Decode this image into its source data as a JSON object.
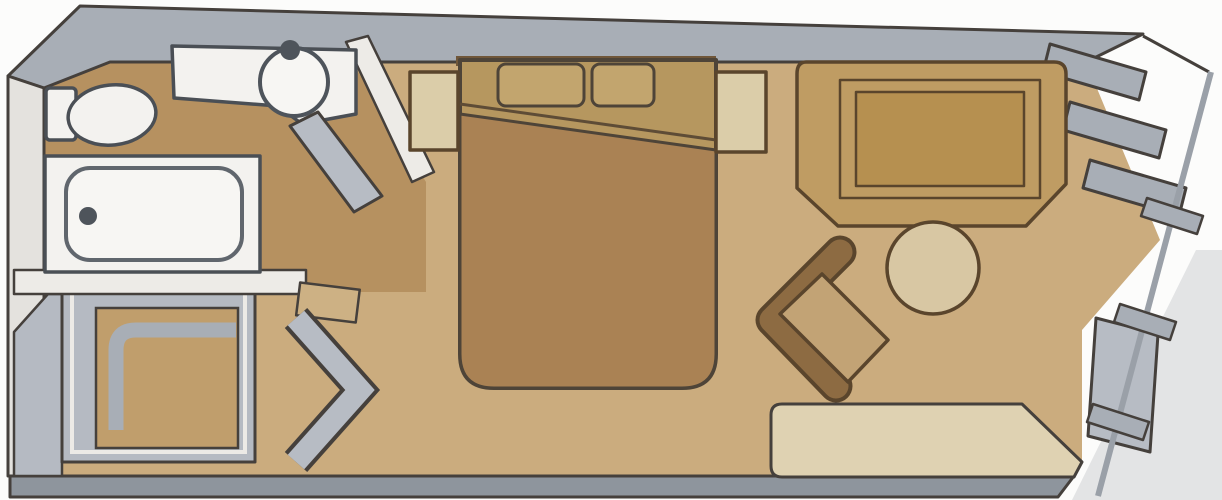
{
  "diagram": {
    "type": "floor-plan",
    "subject": "Stateroom cabin floor plan with private balcony",
    "rooms": [
      {
        "name": "bathroom",
        "items": [
          "toilet",
          "sink vanity",
          "bathtub",
          "bathroom door"
        ]
      },
      {
        "name": "entry",
        "items": [
          "wardrobe closet",
          "entry door",
          "shelf"
        ]
      },
      {
        "name": "bedroom",
        "items": [
          "double bed",
          "two pillows",
          "left nightstand",
          "right nightstand"
        ]
      },
      {
        "name": "sitting area",
        "items": [
          "desk cabinet",
          "armchair",
          "round table",
          "sofa"
        ]
      },
      {
        "name": "balcony",
        "items": [
          "louvered angled wall",
          "glass partition",
          "railing"
        ]
      }
    ]
  },
  "colors": {
    "background": "#fcfcfb",
    "shadow": "#dcdde0",
    "floor_main": "#cbac7e",
    "floor_bath": "#b69160",
    "wall_gray": "#a8aeb6",
    "wall_light": "#e4e2de",
    "wall_bottom": "#8e959d",
    "wall_white": "#edebe7",
    "closet_gray": "#b5bac2",
    "closet_inner": "#c09e6c",
    "shelf": "#cdb184",
    "fixture_white": "#f3f2ef",
    "fixture_inner": "#f7f6f3",
    "faucet_dark": "#4e545b",
    "door_gray": "#b7bcc4",
    "bed_top": "#b6975f",
    "bed_duvet": "#aa8254",
    "pillow": "#c2a56e",
    "headboard": "#70573a",
    "nightstand": "#dbcda9",
    "desk": "#bf9c63",
    "desk_inner": "#b69050",
    "table": "#d8c7a3",
    "chair_back": "#8d6b42",
    "chair_seat": "#c2a375",
    "sofa": "#dfd2b2",
    "railing": "#9aa0a8"
  }
}
